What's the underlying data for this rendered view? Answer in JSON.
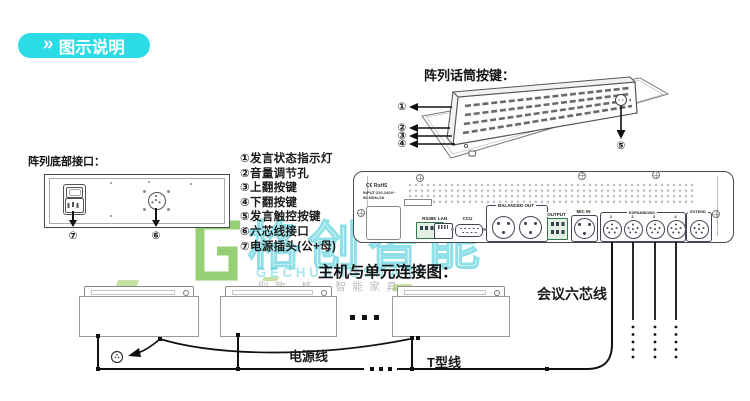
{
  "badge": {
    "label": "图示说明"
  },
  "sections": {
    "array_buttons_title": "阵列话筒按键：",
    "bottom_ports_title": "阵列底部接口：",
    "connection_title": "主机与单元连接图："
  },
  "legend": {
    "items": [
      "①发言状态指示灯",
      "②音量调节孔",
      "③上翻按键",
      "④下翻按键",
      "⑤发言触控按键",
      "⑥六芯线接口",
      "⑦电源插头(公+母)"
    ]
  },
  "callouts": {
    "n1": "①",
    "n2": "②",
    "n3": "③",
    "n4": "④",
    "n5": "⑤",
    "n6": "⑥",
    "n7": "⑦"
  },
  "host": {
    "ce_mark": "C€ RoHS",
    "input_line1": "INPUT:220-240V~",
    "input_line2": "50-60Hz,5A",
    "ports": {
      "rs485": "RS485",
      "lan": "LAN",
      "ccu": "CCU",
      "balanced_out": "BALANCED OUT",
      "output": "OUTPUT",
      "mic_in": "MIC IN",
      "expansion_group": "EXPANSIONS",
      "extend": "EXTEND"
    },
    "din_numbers": [
      "1",
      "2",
      "3",
      "4"
    ]
  },
  "connection_labels": {
    "six_core": "会议六芯线",
    "power": "电源线",
    "t_line": "T型线"
  },
  "watermark": {
    "brand_cn": "格创智能",
    "brand_en": "GECHUANGSMART",
    "slogan": "别致 格．智能家具"
  },
  "colors": {
    "accent_cyan": "#2BDCE6",
    "watermark_teal": "#3EC9D6",
    "watermark_green": "#72BF44",
    "line_black": "#111111"
  }
}
